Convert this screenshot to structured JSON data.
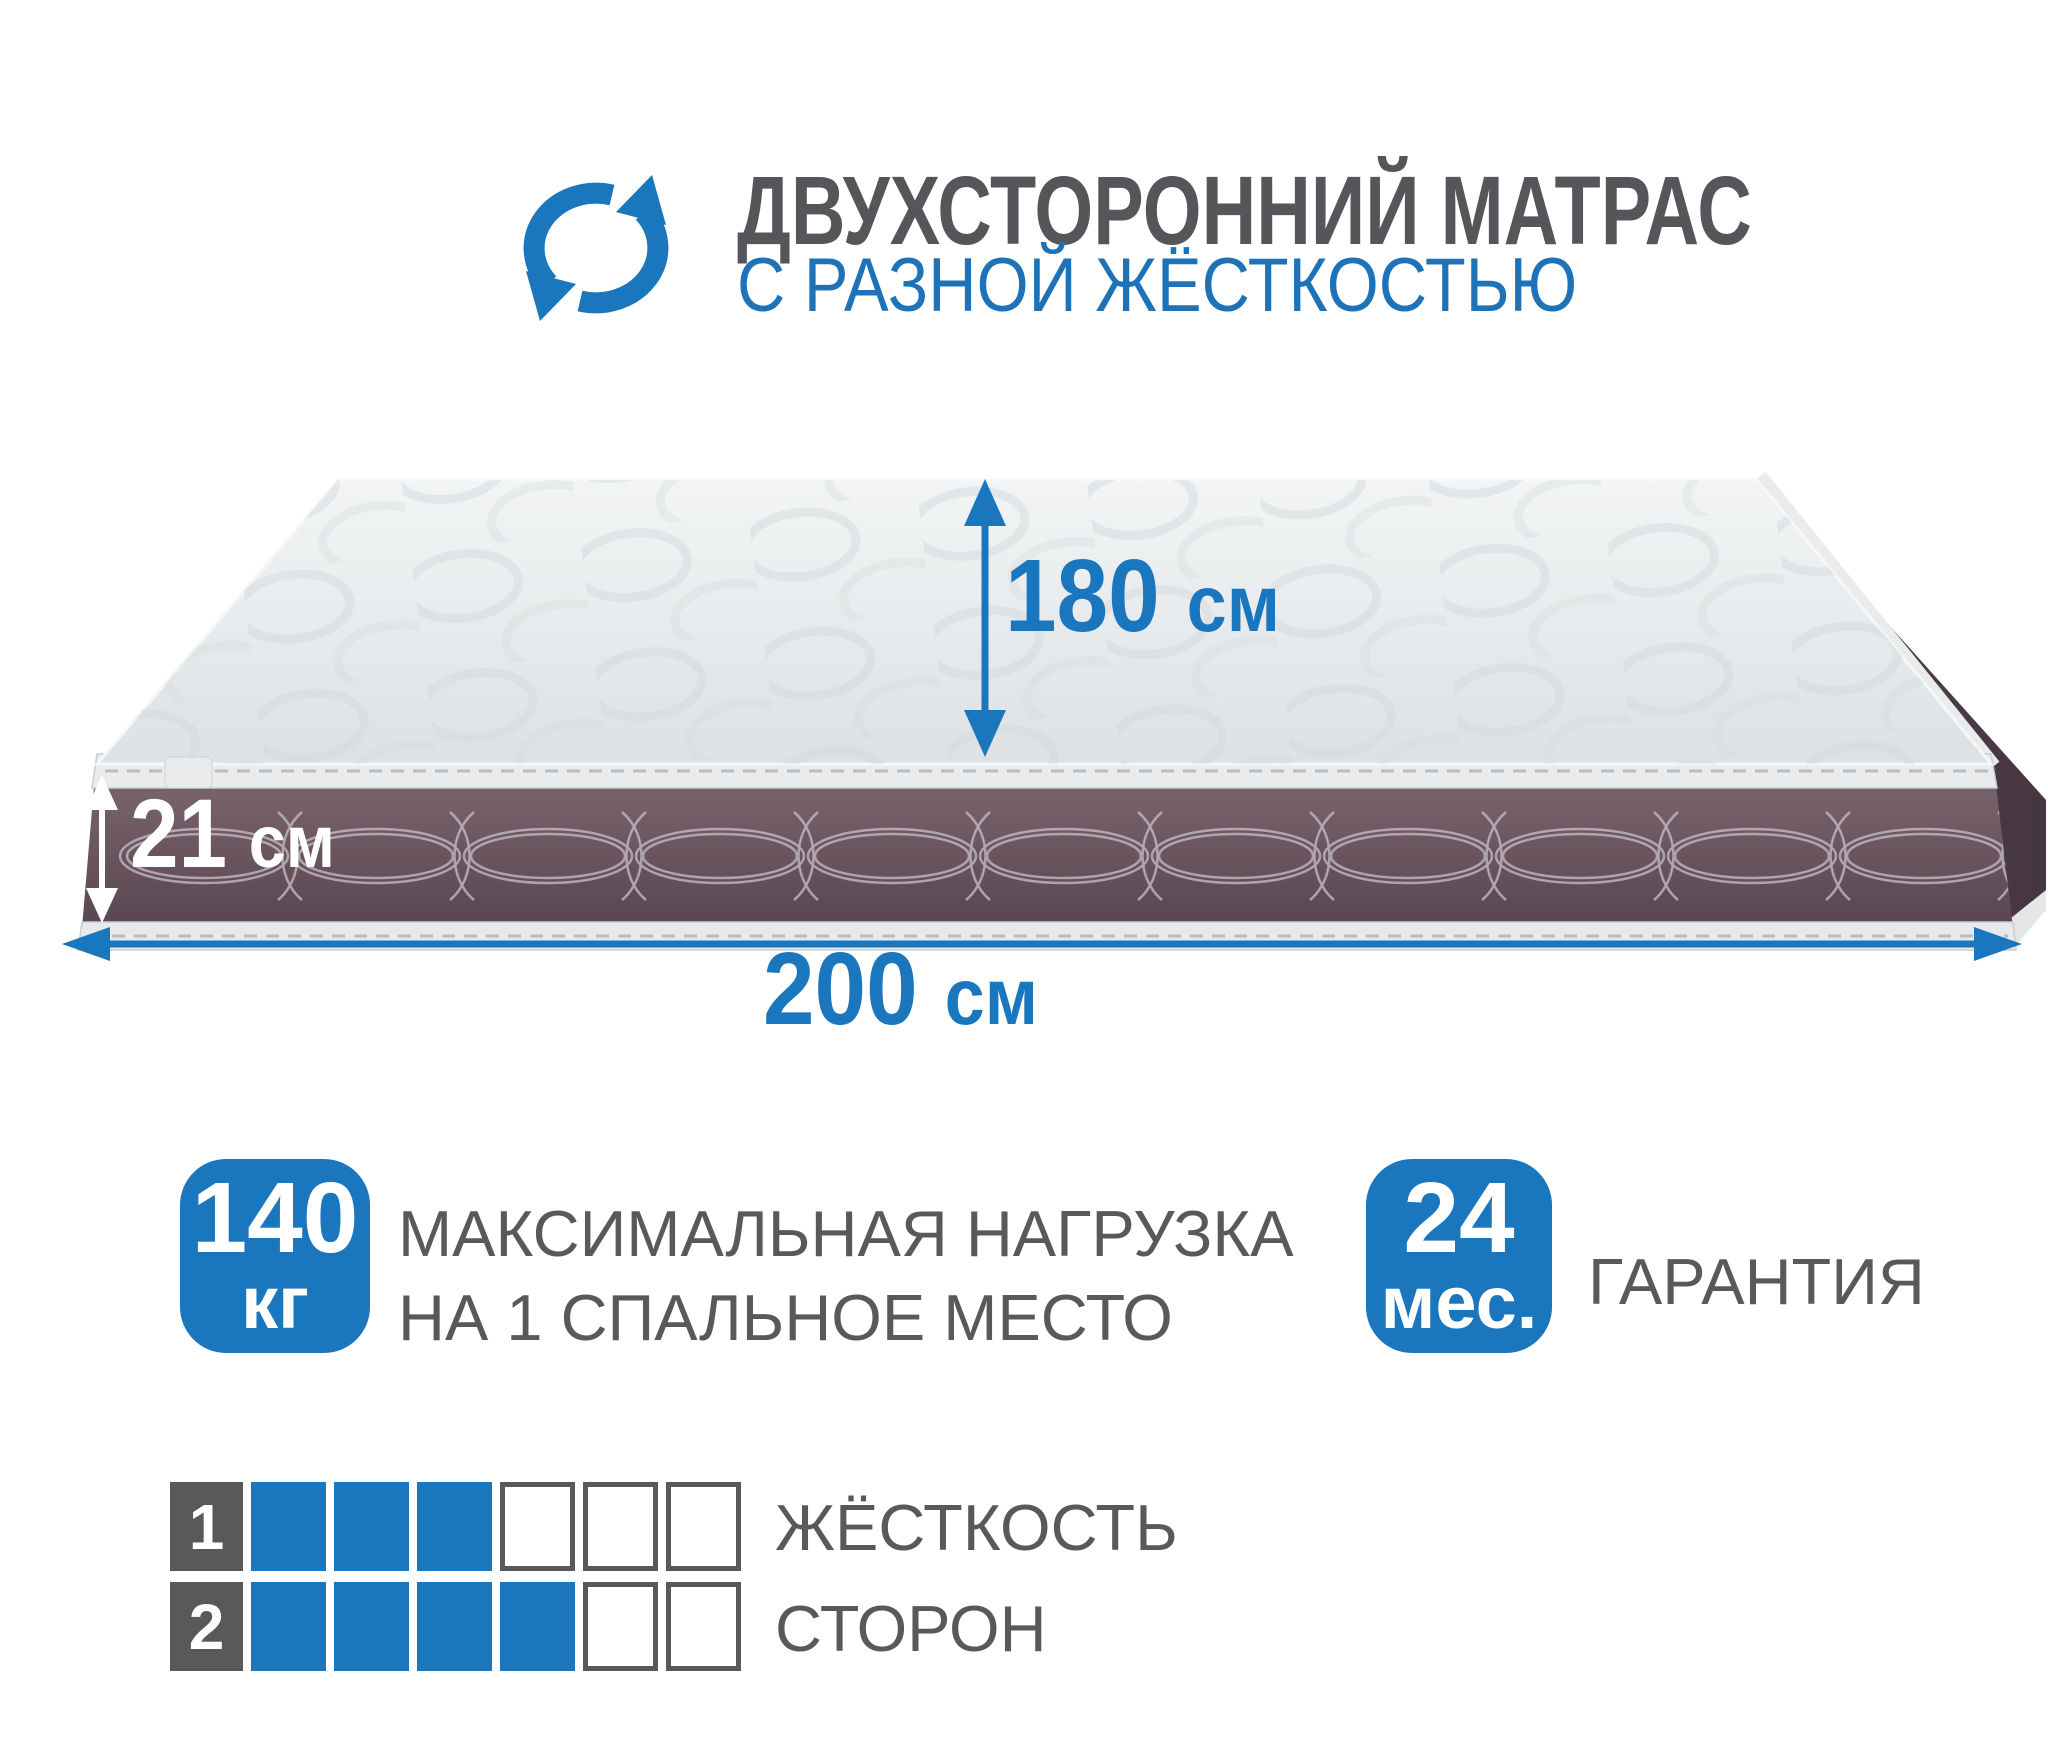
{
  "header": {
    "title": "ДВУХСТОРОННИЙ МАТРАС",
    "subtitle": "С РАЗНОЙ ЖЁСТКОСТЬЮ",
    "icon": "rotate-arrows"
  },
  "dimensions": {
    "width": {
      "value": "180",
      "unit": "см"
    },
    "thickness": {
      "value": "21",
      "unit": "см"
    },
    "length": {
      "value": "200",
      "unit": "см"
    }
  },
  "max_load": {
    "value": "140",
    "unit": "кг",
    "line1": "МАКСИМАЛЬНАЯ НАГРУЗКА",
    "line2": "НА 1 СПАЛЬНОЕ МЕСТО"
  },
  "warranty": {
    "value": "24",
    "unit": "мес.",
    "label": "ГАРАНТИЯ"
  },
  "firmness": {
    "line1": "ЖЁСТКОСТЬ",
    "line2": "СТОРОН",
    "scale": 6,
    "rows": [
      {
        "side": "1",
        "filled": 3
      },
      {
        "side": "2",
        "filled": 4
      }
    ]
  },
  "colors": {
    "accent_blue": "#1a76bd",
    "text_gray": "#58595b",
    "title_gray": "#55565a",
    "band_brown": "#6b565f",
    "mattress_top": "#e7eaec",
    "piping_light": "#e9ebed"
  }
}
